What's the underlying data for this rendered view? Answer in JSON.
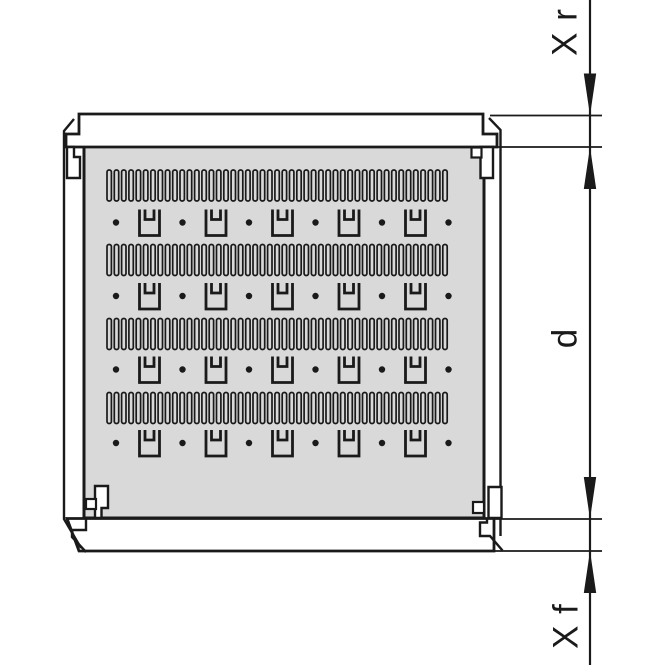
{
  "figure": {
    "title": "rack shelf plate dimension drawing",
    "background": "#ffffff",
    "ink": "#1a1a1a",
    "panel_fill": "#d9d9d9",
    "dimension_labels": {
      "rear": "X r",
      "depth": "d",
      "front": "X f"
    },
    "geometry": {
      "canvas": [
        665,
        665
      ],
      "dim_line_x": 590,
      "dim_line_width": 2.2,
      "ext_lines": {
        "x1": 490,
        "x2": 602,
        "ys": [
          115.5,
          147,
          519,
          551
        ],
        "width": 1.8
      },
      "arrow_len": 42,
      "arrow_half_w": 6.2,
      "arrows": [
        {
          "tip_y": 115.5,
          "point": "down"
        },
        {
          "tip_y": 147,
          "point": "up"
        },
        {
          "tip_y": 519,
          "point": "down"
        },
        {
          "tip_y": 551,
          "point": "up"
        }
      ],
      "labels_pos": {
        "rear": [
          565,
          32
        ],
        "depth": [
          565,
          338
        ],
        "front": [
          566,
          626
        ]
      },
      "panel": [
        84,
        146,
        400,
        372
      ],
      "panel_stroke": 3,
      "rail_stroke": 2.8,
      "wall_stroke": 2.4,
      "rails": [
        "M79 114 H483 V134 H497 V147 H66 V134 H79 Z",
        "M67 518.5 H494 V551 H79 Z"
      ],
      "walls": [
        "M74 119 L64 131 V519 L81 548",
        "M489 118 L500.5 130 V536",
        "M86 518 V530 H72 V537 L86 552",
        "M487 518 V522.5 H480 V536 H490 L502.5 550.5"
      ],
      "tabs": [
        "M67 147 V178 H80 V157 H74 V147 Z",
        "M480.5 147 V178 H493 V147 Z",
        "M95 518 V486 H108 V508 H101.5 V518 Z",
        "M488.5 518 V487 H501.5 V518 Z"
      ],
      "corner_squares": [
        [
          471.5,
          147.5,
          10,
          10
        ],
        [
          86,
          499,
          10,
          10
        ],
        [
          473,
          502,
          11,
          11
        ]
      ],
      "slot_strips": {
        "x": 107,
        "width": 340,
        "height": 31,
        "tops": [
          170,
          244.5,
          318.5,
          392.5
        ],
        "count": 47,
        "pitch": 7.3,
        "slot_w": 4.4,
        "rx": 2,
        "stroke": 1.7
      },
      "clip_rows": {
        "centers_y": [
          222.5,
          296,
          369.5,
          443
        ],
        "dot_xs": [
          116,
          182.5,
          249,
          315.5,
          382,
          448.5
        ],
        "clip_xs": [
          149.5,
          216,
          282.5,
          349,
          415.5
        ],
        "dot_r": 3.2,
        "clip": {
          "half_w": 10,
          "half_h": 13,
          "inner_half_w": 4.5,
          "inner_bar_y": -3,
          "stroke": 2.8
        }
      }
    }
  }
}
